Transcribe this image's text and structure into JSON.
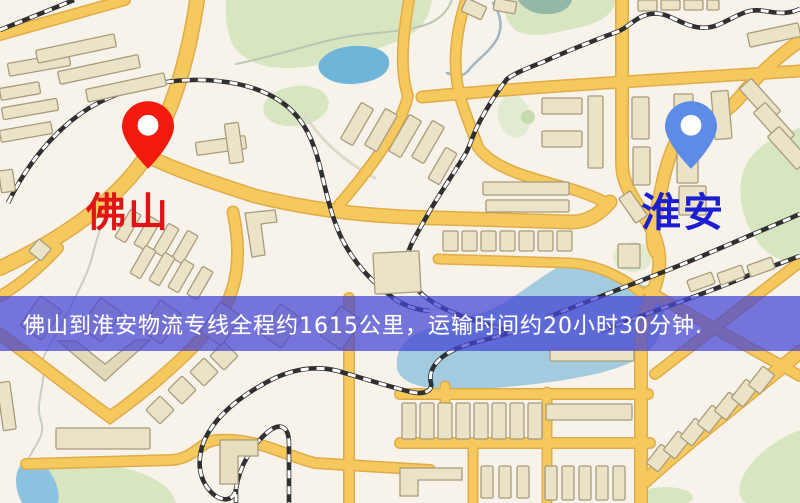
{
  "map": {
    "markers": {
      "origin": {
        "name": "佛山",
        "pin_color": "#f2190f",
        "label_color": "#e01414"
      },
      "destination": {
        "name": "淮安",
        "pin_color": "#5c8ce6",
        "label_color": "#1c1fd1"
      }
    },
    "banner": {
      "text": "佛山到淮安物流专线全程约1615公里，运输时间约20小时30分钟.",
      "background": "#4444d5",
      "text_color": "#ffffff"
    },
    "palette": {
      "map_background": "#f7f2ea",
      "road_fill": "#f5c95e",
      "road_casing": "#e0ac48",
      "railway": "#303030",
      "green_area": "#d7e6c1",
      "water": "#8cc3e0",
      "lake": "#6fb5d9",
      "building": "#ebe3c8",
      "building_outline": "#a89c7c"
    }
  }
}
